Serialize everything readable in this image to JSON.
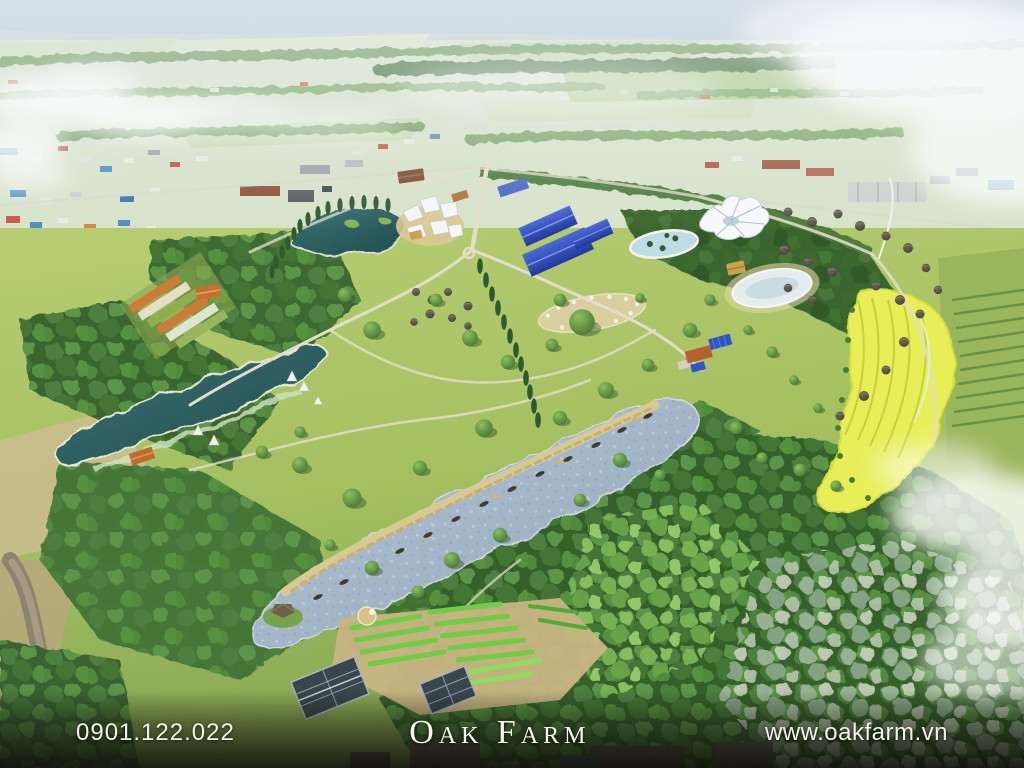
{
  "footer": {
    "phone": "0901.122.022",
    "brand": "Oak Farm",
    "website": "www.oakfarm.vn"
  },
  "palette": {
    "sky_haze": "#ccd9e4",
    "distant_field": "#d7e3c9",
    "lawn_green": "#a9c361",
    "forest_green": "#44743a",
    "lake_teal": "#2e5f60",
    "lake_light": "#a5b9ca",
    "sand_shore": "#d9c98f",
    "yellow_field": "#e7ee58",
    "roof_blue": "#3353c0",
    "footer_text": "#f2f0e6"
  }
}
